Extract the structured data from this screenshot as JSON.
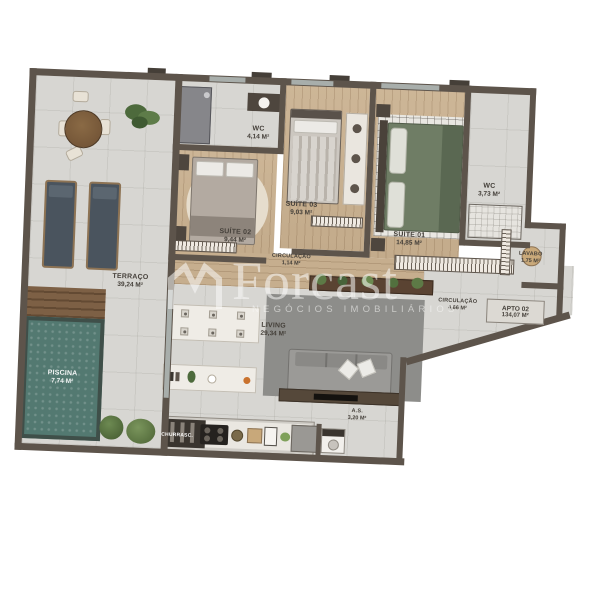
{
  "watermark": {
    "brand": "Forcast",
    "subtitle": "NEGÓCIOS IMOBILIÁRIOS"
  },
  "badge": {
    "title": "APTO 02",
    "area": "134,07 M²"
  },
  "rooms": {
    "terraco": {
      "name": "TERRAÇO",
      "area": "39,24 M²"
    },
    "piscina": {
      "name": "PISCINA",
      "area": "7,74 M²"
    },
    "suite02": {
      "name": "SUÍTE 02",
      "area": "9,44 M²"
    },
    "wc_suites": {
      "name": "WC",
      "area": "4,14 M²"
    },
    "suite03": {
      "name": "SUÍTE 03",
      "area": "9,03 M²"
    },
    "circulacao_intima": {
      "name": "CIRCULAÇÃO",
      "area": "1,14 M²"
    },
    "suite01": {
      "name": "SUÍTE 01",
      "area": "14,85 M²"
    },
    "wc_suite01": {
      "name": "WC",
      "area": "3,73 M²"
    },
    "lavabo": {
      "name": "LAVABO",
      "area": "1,75 M²"
    },
    "circulacao_social": {
      "name": "CIRCULAÇÃO",
      "area": "4,66 M²"
    },
    "living": {
      "name": "LIVING",
      "area": "29,34 M²"
    },
    "area_servico": {
      "name": "A.S.",
      "area": "3,20 M²"
    },
    "churrasqueira": {
      "name": "CHURRASC."
    }
  },
  "colors": {
    "wall": "#5d544b",
    "wood_floor": "#c9b294",
    "tile_floor": "#d7d6d2",
    "pool_water": "#537971",
    "deck_wood": "#7d6045",
    "bed_green": "#6f7d65",
    "sofa_gray": "#97968f"
  }
}
